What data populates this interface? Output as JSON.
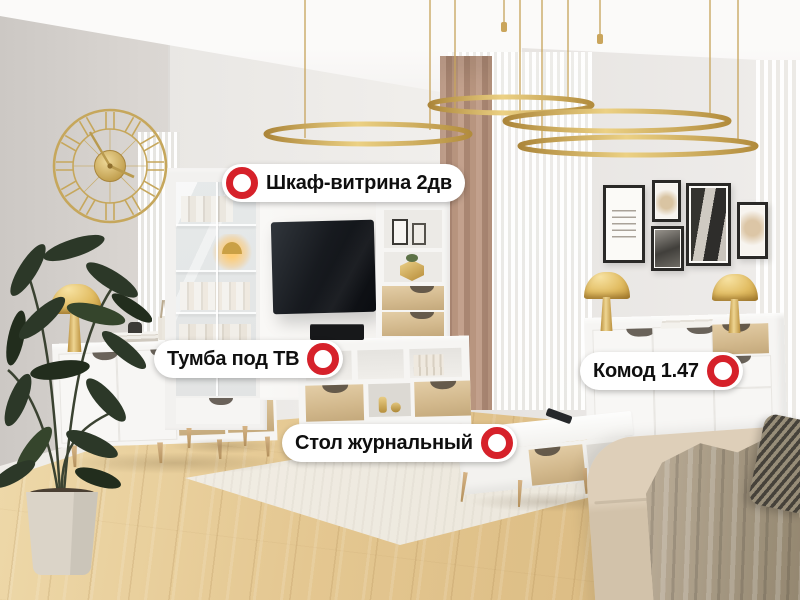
{
  "hotspots": [
    {
      "name": "cabinet",
      "label": "Шкаф-витрина 2дв",
      "marker_side": "left"
    },
    {
      "name": "tv-stand",
      "label": "Тумба под ТВ",
      "marker_side": "right"
    },
    {
      "name": "dresser",
      "label": "Комод 1.47",
      "marker_side": "right"
    },
    {
      "name": "coffee-table",
      "label": "Стол журнальный",
      "marker_side": "right"
    }
  ],
  "marker": {
    "type": "red-ring",
    "ring_color": "#d6212a",
    "fill": "#ffffff"
  },
  "palette": {
    "label_bg": "#ffffff",
    "label_text": "#0f0f0f",
    "gold": "#c9a45a",
    "wall": "#dcd8d4",
    "floor_wood": "#e0c08a",
    "oak_accent": "#d4b989",
    "curtain_tan": "#b3917d",
    "sofa_beige": "#d8c9b2",
    "tv_black": "#14171b"
  }
}
